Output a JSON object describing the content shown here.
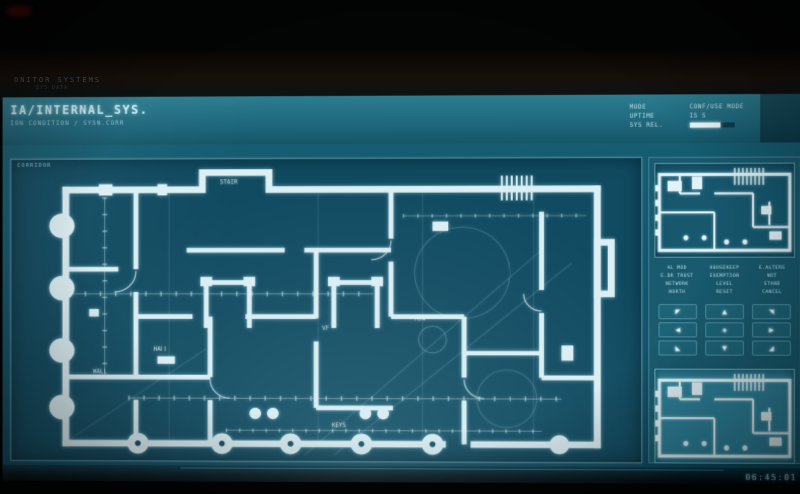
{
  "ambient": {
    "line1": "ONITOR SYSTEMS",
    "line2": "SYS DATA"
  },
  "header": {
    "title": "IA/INTERNAL_SYS.",
    "subtitle": "ION CONDITION / SYSN.CORR",
    "status_labels": [
      "MODE",
      "UPTIME",
      "SYS REL."
    ],
    "status_value_1": "CONF/USE  MODE",
    "status_value_2": "IS S"
  },
  "main_panel": {
    "tag": "CORRIDOR"
  },
  "blueprint": {
    "labels": [
      {
        "text": "STAIR"
      },
      {
        "text": "HALL"
      },
      {
        "text": "VF"
      },
      {
        "text": "WALL"
      },
      {
        "text": "KEYS"
      },
      {
        "text": "M04"
      }
    ]
  },
  "right_panel": {
    "table": {
      "rows": [
        [
          "AL MOD",
          "HOUSEKEEP",
          "E.ALTERS"
        ],
        [
          "E.DR TRUST",
          "EXEMPTION",
          "NOT"
        ],
        [
          "NETWORK",
          "LEVEL",
          "STAND"
        ],
        [
          "NORTH",
          "RESET",
          "CANCEL"
        ]
      ]
    },
    "arrows": {
      "up_left": "◤",
      "up": "▲",
      "up_right": "◥",
      "left": "◀",
      "center": "✚",
      "right": "▶",
      "down_left": "◣",
      "down": "▼",
      "down_right": "◢"
    }
  },
  "footer": {
    "clock": "06:45:01"
  },
  "colors": {
    "screen_teal": "#176074",
    "blueprint_bg": "#114b61",
    "line": "#dceff4",
    "accent": "#8fcbd8"
  }
}
